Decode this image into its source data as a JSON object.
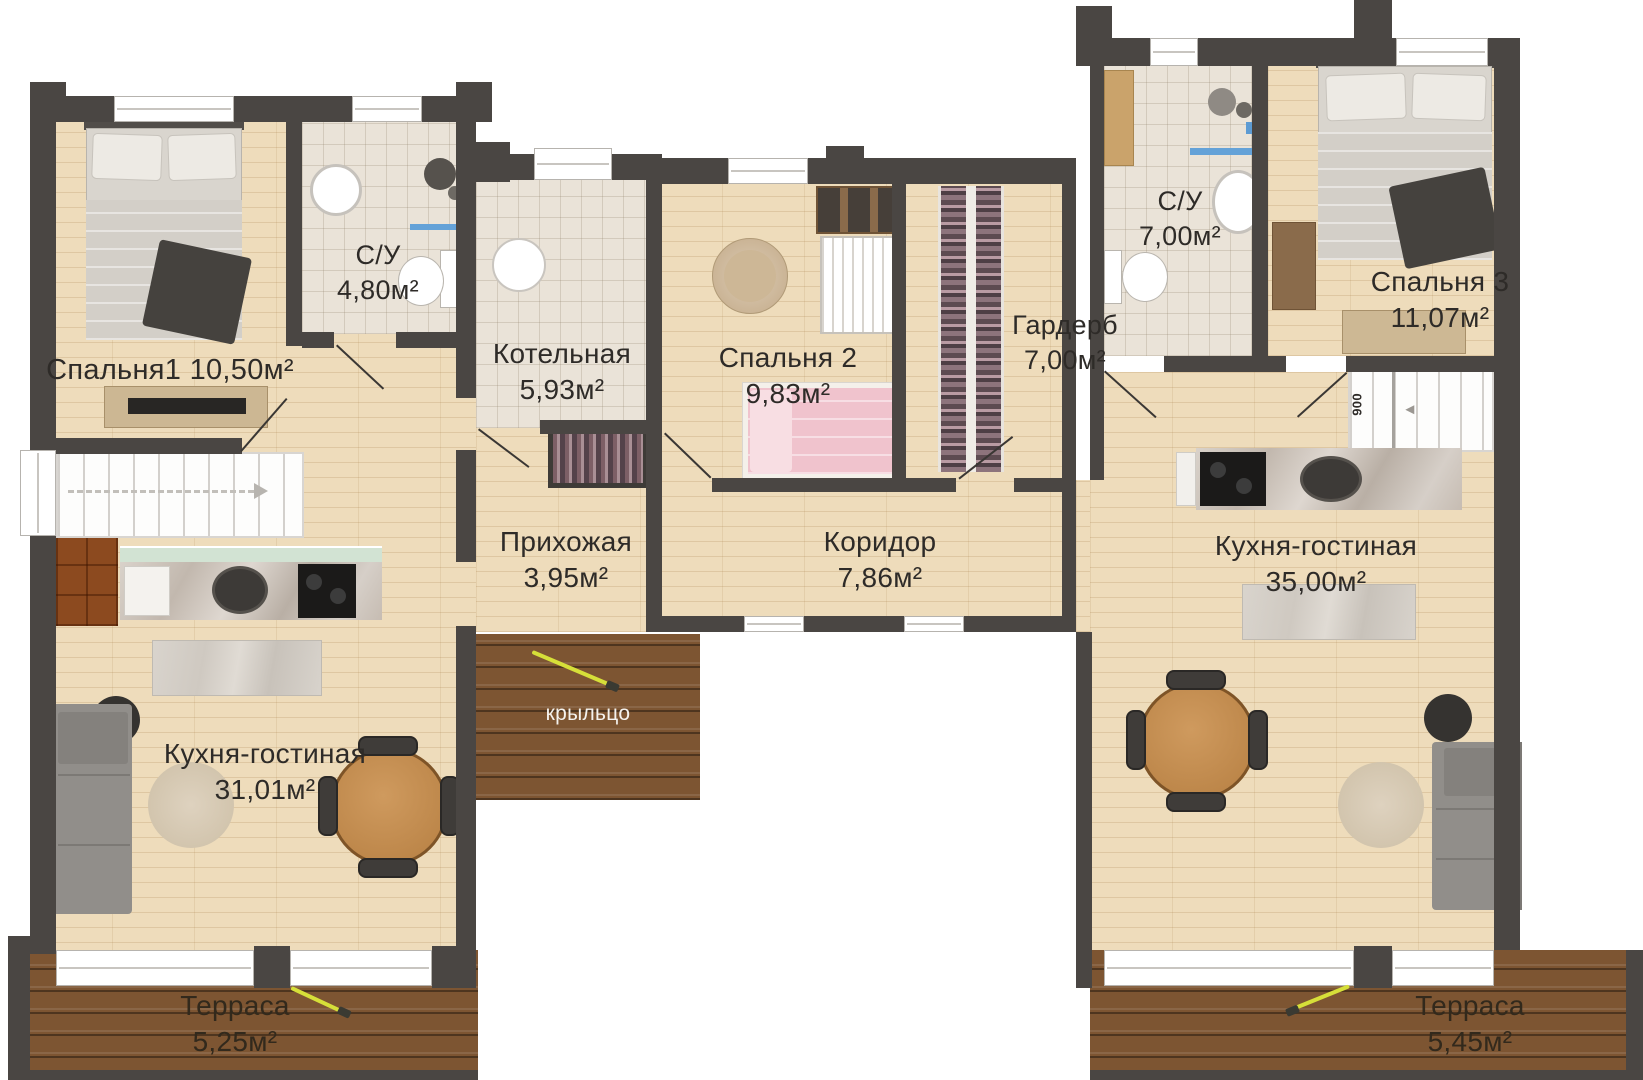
{
  "rooms": {
    "bedroom1": {
      "name": "Спальня1",
      "area": "10,50м²"
    },
    "bath1": {
      "name": "С/У",
      "area": "4,80м²"
    },
    "boiler": {
      "name": "Котельная",
      "area": "5,93м²"
    },
    "hallway": {
      "name": "Прихожая",
      "area": "3,95м²"
    },
    "bedroom2": {
      "name": "Спальня 2",
      "area": "9,83м²"
    },
    "wardrobe": {
      "name": "Гардерб",
      "area": "7,00м²"
    },
    "bath2": {
      "name": "С/У",
      "area": "7,00м²"
    },
    "bedroom3": {
      "name": "Спальня 3",
      "area": "11,07м²"
    },
    "corridor": {
      "name": "Коридор",
      "area": "7,86м²"
    },
    "kitchen_left": {
      "name": "Кухня-гостиная",
      "area": "31,01м²"
    },
    "kitchen_right": {
      "name": "Кухня-гостиная",
      "area": "35,00м²"
    },
    "terrace_left": {
      "name": "Терраса",
      "area": "5,25м²"
    },
    "terrace_right": {
      "name": "Терраса",
      "area": "5,45м²"
    },
    "porch": {
      "name": "крыльцо"
    }
  },
  "annotations": {
    "stair_width": "900",
    "stair_arrow_right": "◄"
  },
  "colors": {
    "wall": "#4a4643",
    "floor_wood": "#eedcbb",
    "floor_tile": "#eae3d8",
    "terrace_planks": "#7d5532",
    "entrance_arrow": "#d6df39",
    "water_blue": "#64a2d8"
  }
}
